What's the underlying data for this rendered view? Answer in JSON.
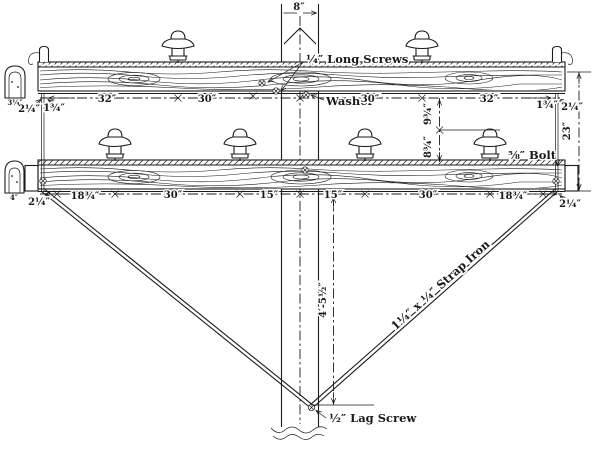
{
  "colors": {
    "ink": "#1a1a1a",
    "paper": "#ffffff"
  },
  "labels": {
    "pole_width": "8″",
    "long_screws": "¼″ Long Screws",
    "washer": "Washer",
    "bolt": "⅝″ Bolt",
    "lag_screw": "½″ Lag Screw",
    "strap_iron": "1¼″ x ¼″ Strap Iron",
    "drop": "4′-5½″",
    "gap_upper": "9¾″",
    "gap_lower": "8¾″",
    "overall_right": "23″"
  },
  "upper_arm": {
    "end_left_outer": "2¼″",
    "end_left_inner": "1¾″",
    "seg1": "32″",
    "seg2": "30″",
    "seg3": "30″",
    "seg4": "32″",
    "end_right_inner": "1¾″",
    "end_right_outer": "2¼″"
  },
  "lower_arm": {
    "end_left": "2¼″",
    "seg1": "18¾″",
    "seg2": "30″",
    "seg3": "15″",
    "seg4": "15″",
    "seg5": "30″",
    "seg6": "18¾″",
    "end_right": "2¼″"
  },
  "sections": {
    "upper_width": "3¼″",
    "lower_width": "4″"
  }
}
